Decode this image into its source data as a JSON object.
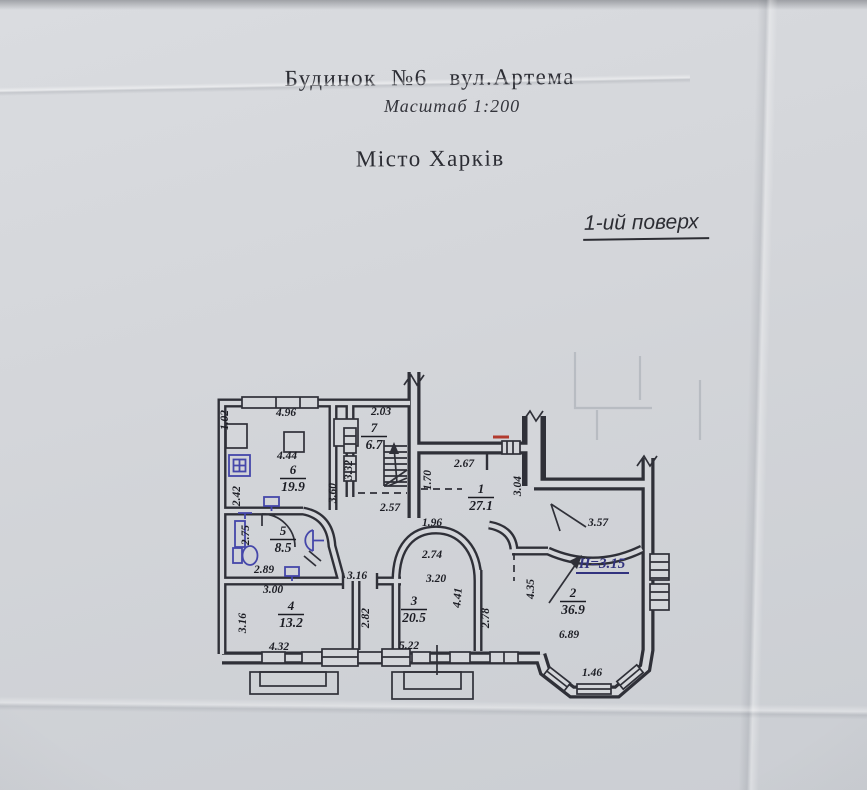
{
  "header": {
    "line1": "Будинок  №6   вул.Артема",
    "line2": "Місто Харків",
    "scale": "Масштаб 1:200",
    "floor": "1-ий поверх"
  },
  "plan": {
    "height_note": "H=3.15",
    "colors": {
      "paper": "#d4d6da",
      "line": "#2f3038",
      "ink": "#1c1d24",
      "blue_ink": "#4547aa",
      "note_blue": "#32337f",
      "red_mark": "#b23a2e"
    },
    "rooms": [
      {
        "number": "1",
        "area": "27.1",
        "x": 481,
        "y": 493
      },
      {
        "number": "2",
        "area": "36.9",
        "x": 573,
        "y": 597
      },
      {
        "number": "3",
        "area": "20.5",
        "x": 414,
        "y": 605
      },
      {
        "number": "4",
        "area": "13.2",
        "x": 291,
        "y": 610
      },
      {
        "number": "5",
        "area": "8.5",
        "x": 283,
        "y": 535
      },
      {
        "number": "6",
        "area": "19.9",
        "x": 293,
        "y": 474
      },
      {
        "number": "7",
        "area": "6.7",
        "x": 374,
        "y": 432
      }
    ],
    "dimensions": [
      {
        "text": "1.02",
        "x": 228,
        "y": 420,
        "rot": -90
      },
      {
        "text": "4.96",
        "x": 286,
        "y": 416,
        "rot": 0
      },
      {
        "text": "4.44",
        "x": 287,
        "y": 459,
        "rot": 0
      },
      {
        "text": "2.42",
        "x": 240,
        "y": 496,
        "rot": -90
      },
      {
        "text": "2.03",
        "x": 381,
        "y": 415,
        "rot": 0
      },
      {
        "text": "3.32",
        "x": 352,
        "y": 470,
        "rot": -90
      },
      {
        "text": "3.60",
        "x": 336,
        "y": 493,
        "rot": -90
      },
      {
        "text": "2.57",
        "x": 390,
        "y": 511,
        "rot": 0
      },
      {
        "text": "1.70",
        "x": 431,
        "y": 480,
        "rot": -90
      },
      {
        "text": "2.67",
        "x": 464,
        "y": 467,
        "rot": 0
      },
      {
        "text": "3.04",
        "x": 521,
        "y": 486,
        "rot": -90
      },
      {
        "text": "1.96",
        "x": 432,
        "y": 526,
        "rot": 0
      },
      {
        "text": "2.74",
        "x": 432,
        "y": 558,
        "rot": 0
      },
      {
        "text": "3.20",
        "x": 436,
        "y": 582,
        "rot": 0
      },
      {
        "text": "3.16",
        "x": 357,
        "y": 579,
        "rot": 0
      },
      {
        "text": "2.82",
        "x": 369,
        "y": 618,
        "rot": -90
      },
      {
        "text": "4.41",
        "x": 461,
        "y": 598,
        "rot": -85
      },
      {
        "text": "2.78",
        "x": 489,
        "y": 618,
        "rot": -90
      },
      {
        "text": "5.22",
        "x": 409,
        "y": 649,
        "rot": 0
      },
      {
        "text": "3.00",
        "x": 273,
        "y": 593,
        "rot": 0
      },
      {
        "text": "2.89",
        "x": 264,
        "y": 573,
        "rot": 0
      },
      {
        "text": "2.75",
        "x": 249,
        "y": 535,
        "rot": -90
      },
      {
        "text": "3.16",
        "x": 246,
        "y": 623,
        "rot": -90
      },
      {
        "text": "4.32",
        "x": 279,
        "y": 650,
        "rot": 0
      },
      {
        "text": "3.57",
        "x": 598,
        "y": 526,
        "rot": 0
      },
      {
        "text": "4.35",
        "x": 534,
        "y": 589,
        "rot": -90
      },
      {
        "text": "6.89",
        "x": 569,
        "y": 638,
        "rot": 0
      },
      {
        "text": "1.46",
        "x": 592,
        "y": 676,
        "rot": 0
      }
    ]
  }
}
